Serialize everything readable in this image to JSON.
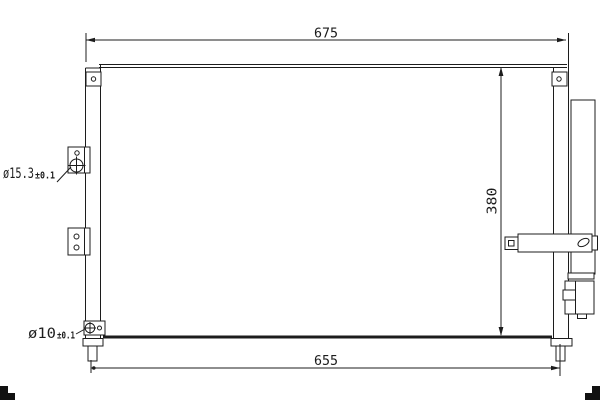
{
  "drawing": {
    "type": "technical-drawing",
    "subject": "condenser front view",
    "colors": {
      "background": "#ffffff",
      "line": "#1c1c1c"
    },
    "dimensions": {
      "width_top": "675",
      "height_right": "380",
      "width_bottom": "655"
    },
    "annotations": {
      "hole_upper": {
        "diameter": "ø15.3",
        "tolerance": "±0.1"
      },
      "hole_lower": {
        "diameter": "ø10",
        "tolerance": "±0.1"
      }
    }
  }
}
